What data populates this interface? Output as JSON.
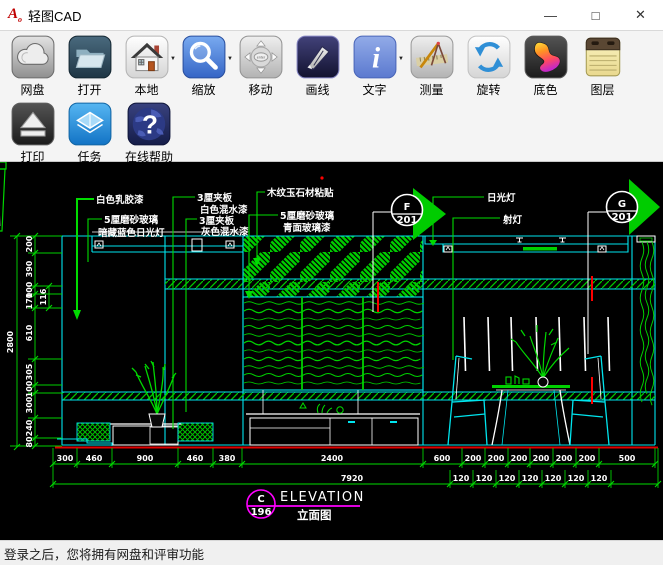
{
  "window": {
    "title": "轻图CAD",
    "controls": {
      "minimize": "—",
      "maximize": "□",
      "close": "✕"
    }
  },
  "toolbar": {
    "row1": [
      {
        "id": "netdisk",
        "label": "网盘"
      },
      {
        "id": "open",
        "label": "打开"
      },
      {
        "id": "local",
        "label": "本地",
        "dropdown": "▼"
      },
      {
        "id": "zoom",
        "label": "缩放",
        "dropdown": "▼"
      },
      {
        "id": "move",
        "label": "移动"
      },
      {
        "id": "drawline",
        "label": "画线"
      },
      {
        "id": "text",
        "label": "文字",
        "dropdown": "▼"
      },
      {
        "id": "measure",
        "label": "测量"
      },
      {
        "id": "rotate",
        "label": "旋转"
      },
      {
        "id": "bgcolor",
        "label": "底色"
      },
      {
        "id": "layers",
        "label": "图层"
      }
    ],
    "row2": [
      {
        "id": "print",
        "label": "打印"
      },
      {
        "id": "tasks",
        "label": "任务"
      },
      {
        "id": "help",
        "label": "在线帮助"
      }
    ]
  },
  "statusbar": {
    "text": "登录之后，您将拥有网盘和评审功能"
  },
  "canvas": {
    "labels": {
      "paint": "白色乳胶漆",
      "frosted_glass_1": "5厘磨砂玻璃",
      "frosted_glass_1b": "暗藏蓝色日光灯",
      "plywood_white": "3厘夹板",
      "plywood_white_b": "白色混水漆",
      "plywood_gray": "3厘夹板",
      "plywood_gray_b": "灰色混水漆",
      "stone": "木纹玉石材粘贴",
      "frosted_glass_2": "5厘磨砂玻璃",
      "frosted_glass_2b": "青面玻璃漆",
      "fluorescent": "日光灯",
      "spotlight": "射灯"
    },
    "markers": {
      "f_letter": "F",
      "f_number": "201",
      "g_letter": "G",
      "g_number": "201",
      "c_letter": "C",
      "c_number": "196",
      "elevation_en": "ELEVATION",
      "elevation_cn": "立面图"
    },
    "dims": {
      "overall_width": "7920",
      "overall_height": "2800",
      "left_chain": [
        "200",
        "390",
        "100",
        "170",
        "610",
        "305",
        "100",
        "300",
        "240",
        "80"
      ],
      "left_offset": "116",
      "bottom_chain": [
        "300",
        "460",
        "900",
        "460",
        "380",
        "2400"
      ],
      "right_chain": [
        "600",
        "200",
        "200",
        "200",
        "200",
        "200",
        "200",
        "500"
      ],
      "right_sub": [
        "120",
        "120",
        "120",
        "120",
        "120",
        "120",
        "120"
      ]
    },
    "colors": {
      "green": "#00dc00",
      "cyan": "#00ffff",
      "red": "#ff2020",
      "magenta": "#ff00ff",
      "white": "#ffffff",
      "background": "#000000"
    }
  }
}
